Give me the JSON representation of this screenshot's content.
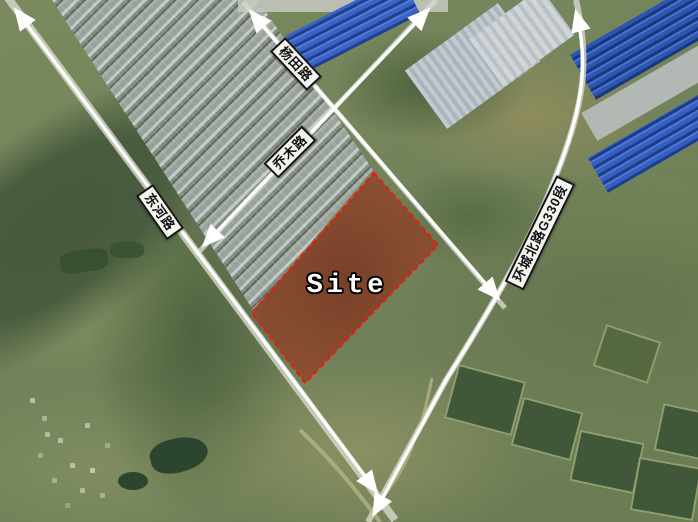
{
  "map": {
    "type": "satellite-annotation",
    "site": {
      "label": "Site"
    },
    "roads": [
      {
        "id": "yangtian",
        "label": "杨田路"
      },
      {
        "id": "qiaomu",
        "label": "乔木路"
      },
      {
        "id": "donghe",
        "label": "东河路"
      },
      {
        "id": "huancheng",
        "label": "环城北路G330段"
      }
    ],
    "colors": {
      "site-fill": "#b0472e",
      "site-border": "#f01810",
      "arrow": "#ffffff",
      "label-bg": "#f4f4f0",
      "label-border": "#141414",
      "label-text": "#111111"
    }
  }
}
